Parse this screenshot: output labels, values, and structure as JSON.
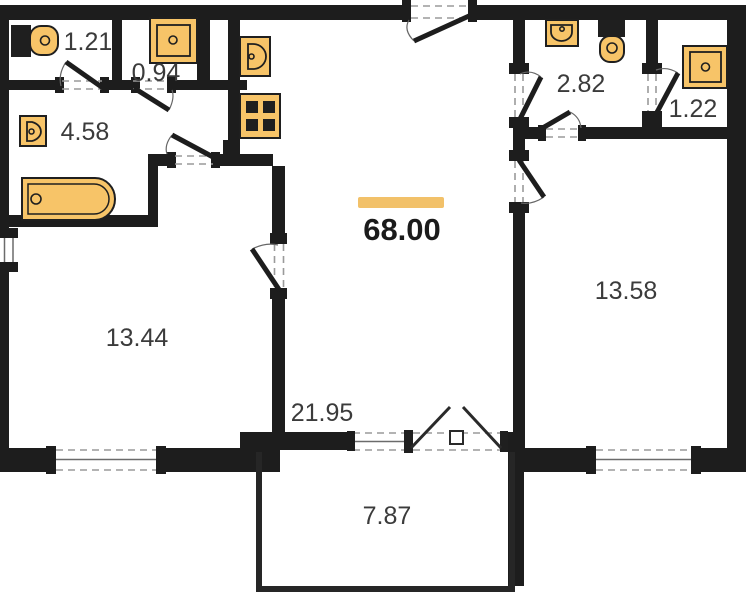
{
  "plan": {
    "type": "apartment-floor-plan",
    "total_area": "68.00",
    "rooms": [
      {
        "name": "wc-left",
        "area": "1.21",
        "fixtures": [
          "toilet-icon"
        ]
      },
      {
        "name": "shower-room-left",
        "area": "0.94",
        "fixtures": [
          "shower-tray-icon"
        ]
      },
      {
        "name": "bathroom",
        "area": "4.58",
        "fixtures": [
          "washbasin-icon",
          "bathtub-icon"
        ]
      },
      {
        "name": "wc-right",
        "area": "2.82",
        "fixtures": [
          "washbasin-icon",
          "toilet-icon"
        ]
      },
      {
        "name": "shower-room-right",
        "area": "1.22",
        "fixtures": [
          "shower-tray-icon"
        ]
      },
      {
        "name": "bedroom-left",
        "area": "13.44",
        "features": [
          "window"
        ]
      },
      {
        "name": "kitchen-living-room",
        "area": "21.95",
        "fixtures": [
          "kitchen-sink-icon",
          "stove-icon"
        ]
      },
      {
        "name": "bedroom-right",
        "area": "13.58",
        "features": [
          "window"
        ]
      },
      {
        "name": "balcony",
        "area": "7.87",
        "features": [
          "french-door"
        ]
      }
    ],
    "colors": {
      "wall": "#1d1d1d",
      "fixture": "#F7C468",
      "accent_bar": "#F2C169",
      "label_text": "#3b3b3b",
      "dash": "#9a9a9a",
      "background": "#ffffff"
    }
  }
}
